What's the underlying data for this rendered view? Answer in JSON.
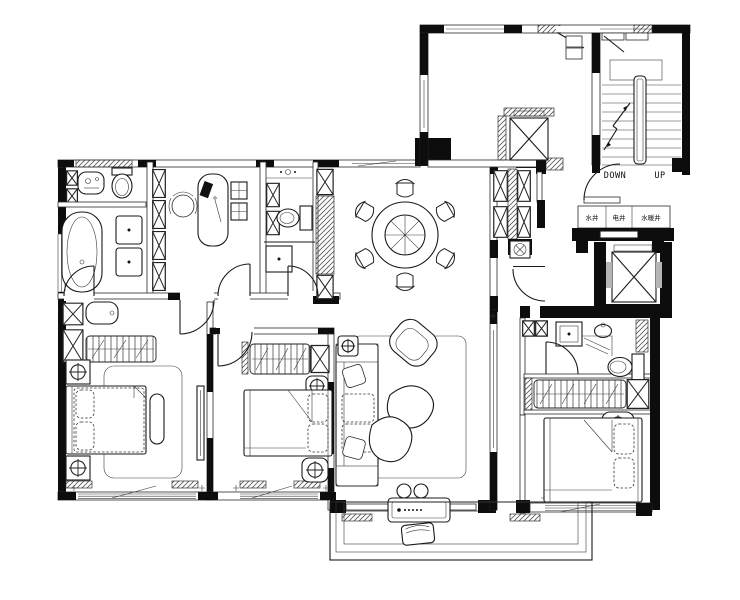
{
  "labels": {
    "stairs_down": "DOWN",
    "stairs_up": "UP",
    "shaft_water": "水井",
    "shaft_electric": "电井",
    "shaft_heating": "水暖井"
  },
  "colors": {
    "ink": "#1a1a1a",
    "wall_fill": "#000000",
    "background": "#ffffff",
    "hatch_line": "#555555"
  }
}
